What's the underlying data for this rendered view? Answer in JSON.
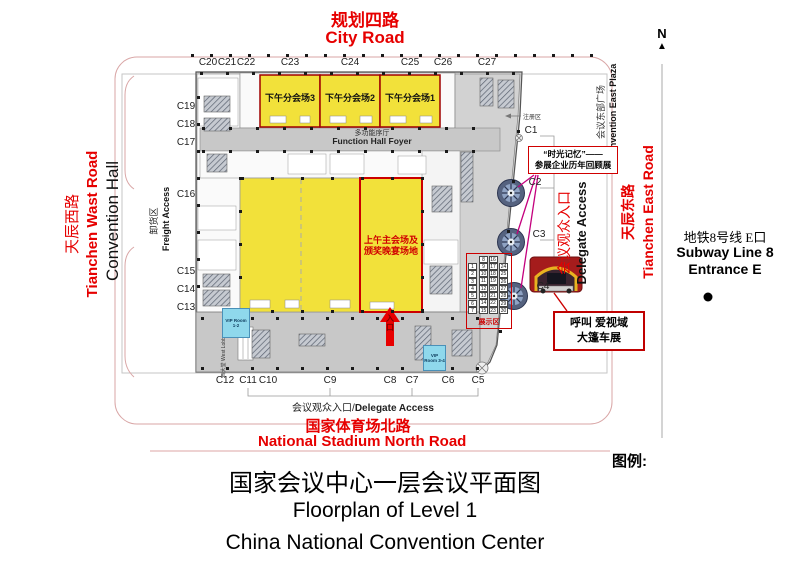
{
  "map_title": {
    "zh": "国家会议中心一层会议平面图",
    "en_line1": "Floorplan of Level 1",
    "en_line2": "China National Convention Center"
  },
  "legend_label": "图例:",
  "north_label": "N",
  "roads": {
    "top": {
      "zh": "规划四路",
      "en": "City Road"
    },
    "west": {
      "zh": "天辰西路",
      "en": "Tianchen Wast Road"
    },
    "east": {
      "zh": "天辰东路",
      "en": "Tianchen East Road"
    },
    "south": {
      "zh": "国家体育场北路",
      "en": "National Stadium North Road"
    }
  },
  "areas": {
    "convention_hall": "Convention Hall",
    "freight": {
      "zh": "卸货区",
      "en": "Freight Access"
    },
    "function_foyer": {
      "zh": "多功能序厅",
      "en": "Function Hall Foyer"
    },
    "east_plaza": {
      "zh": "会议东部广场",
      "en": "Convention East Plaza"
    },
    "delegate_access_east": {
      "zh": "会议观众入口",
      "en": "Delegate Access"
    },
    "delegate_access_south": {
      "zh": "会议观众入口",
      "separator": "/",
      "en": "Delegate Access"
    },
    "registration": "注册区",
    "west_lobby": "西大堂 West Lobby",
    "vip_room_12": "VIP Room 1-2",
    "vip_room_34": "VIP Room 3-4"
  },
  "halls": {
    "afternoon_3": "下午分会场3",
    "afternoon_2": "下午分会场2",
    "afternoon_1": "下午分会场1",
    "main_line1": "上午主会场及",
    "main_line2": "颁奖晚宴场地",
    "entrance": "入口"
  },
  "display_area": {
    "label": "展示区",
    "left_column": [
      1,
      2,
      3,
      4,
      5,
      6,
      7
    ],
    "middle_columns": [
      [
        8,
        16
      ],
      [
        9,
        17
      ],
      [
        10,
        18
      ],
      [
        11,
        19
      ],
      [
        12,
        20
      ],
      [
        13,
        21
      ],
      [
        14,
        22
      ],
      [
        15,
        23
      ]
    ],
    "right_column": [
      24,
      25,
      26,
      27,
      28,
      29,
      30
    ]
  },
  "callouts": {
    "memory_line1": "“时光记忆”——",
    "memory_line2": "参展企业历年回顾展",
    "caravan_line1": "呼叫 爱视域",
    "caravan_line2": "大篷车展"
  },
  "subway": {
    "zh": "地铁8号线 E口",
    "en_line1": "Subway Line 8",
    "en_line2": "Entrance E"
  },
  "entrances": {
    "top": [
      "C20",
      "C21",
      "C22",
      "C23",
      "C24",
      "C25",
      "C26",
      "C27"
    ],
    "west": [
      "C19",
      "C18",
      "C17",
      "C16",
      "C15",
      "C14",
      "C13"
    ],
    "south": [
      "C12",
      "C11",
      "C10",
      "C9",
      "C8",
      "C7",
      "C6",
      "C5"
    ],
    "east": [
      "C1",
      "C2",
      "C3",
      "C4"
    ]
  },
  "colors": {
    "road_red": "#e60000",
    "hall_yellow": "#f2e13a",
    "hall_border_red": "#a00000",
    "highlight_red": "#cc0000",
    "magenta": "#c4007e",
    "vip_blue": "#8fd8ec"
  }
}
